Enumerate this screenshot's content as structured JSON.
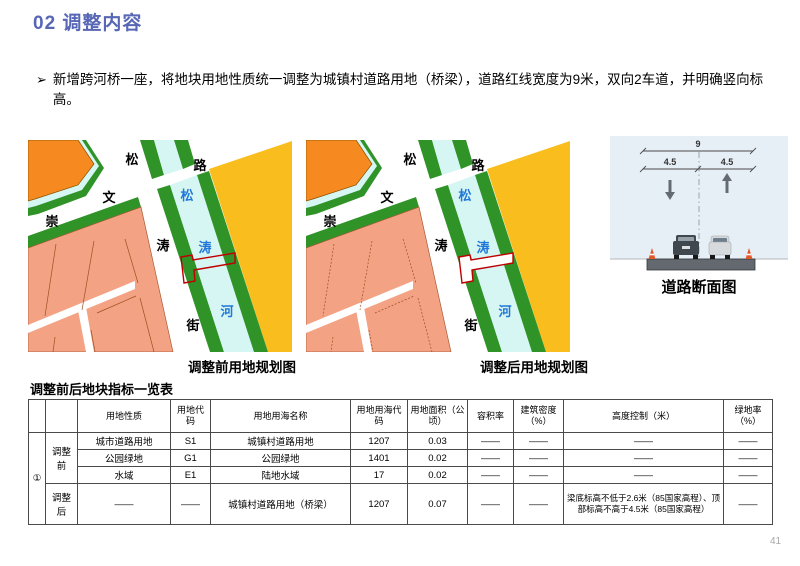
{
  "header": {
    "title": "02 调整内容"
  },
  "bullet": {
    "marker": "➢",
    "text": "新增跨河桥一座，将地块用地性质统一调整为城镇村道路用地（桥梁），道路红线宽度为9米，双向2车道，并明确竖向标高。"
  },
  "maps": {
    "before_caption": "调整前用地规划图",
    "after_caption": "调整后用地规划图",
    "labels": {
      "black": [
        "松",
        "路",
        "文",
        "崇",
        "涛",
        "街"
      ],
      "blue": [
        "松",
        "涛",
        "河"
      ]
    }
  },
  "cross_section": {
    "caption": "道路断面图",
    "total_width": "9",
    "lane_left": "4.5",
    "lane_right": "4.5"
  },
  "table": {
    "title": "调整前后地块指标一览表",
    "headers": [
      "",
      "",
      "用地性质",
      "用地代码",
      "用地用海名称",
      "用地用海代码",
      "用地面积（公顷）",
      "容积率",
      "建筑密度（%）",
      "高度控制（米）",
      "绿地率（%）"
    ],
    "group_id": "①",
    "row_groups": [
      {
        "label": "调整前",
        "rows": [
          [
            "城市道路用地",
            "S1",
            "城镇村道路用地",
            "1207",
            "0.03",
            "——",
            "——",
            "——",
            "——"
          ],
          [
            "公园绿地",
            "G1",
            "公园绿地",
            "1401",
            "0.02",
            "——",
            "——",
            "——",
            "——"
          ],
          [
            "水域",
            "E1",
            "陆地水域",
            "17",
            "0.02",
            "——",
            "——",
            "——",
            "——"
          ]
        ]
      },
      {
        "label": "调整后",
        "rows": [
          [
            "——",
            "——",
            "城镇村道路用地（桥梁）",
            "1207",
            "0.07",
            "——",
            "——",
            "梁底标高不低于2.6米（85国家高程）、顶部标高不高于4.5米（85国家高程）",
            "——"
          ]
        ]
      }
    ]
  },
  "page": {
    "number": "41"
  },
  "colors": {
    "accent_blue": "#5767b6",
    "map_green": "#2f9328",
    "map_cyan": "#d5f6f2",
    "map_yellow": "#f9bd1e",
    "map_orange": "#f6891f",
    "map_pink": "#f4a284",
    "bridge_red": "#c00000",
    "river_label_blue": "#2278d8"
  }
}
